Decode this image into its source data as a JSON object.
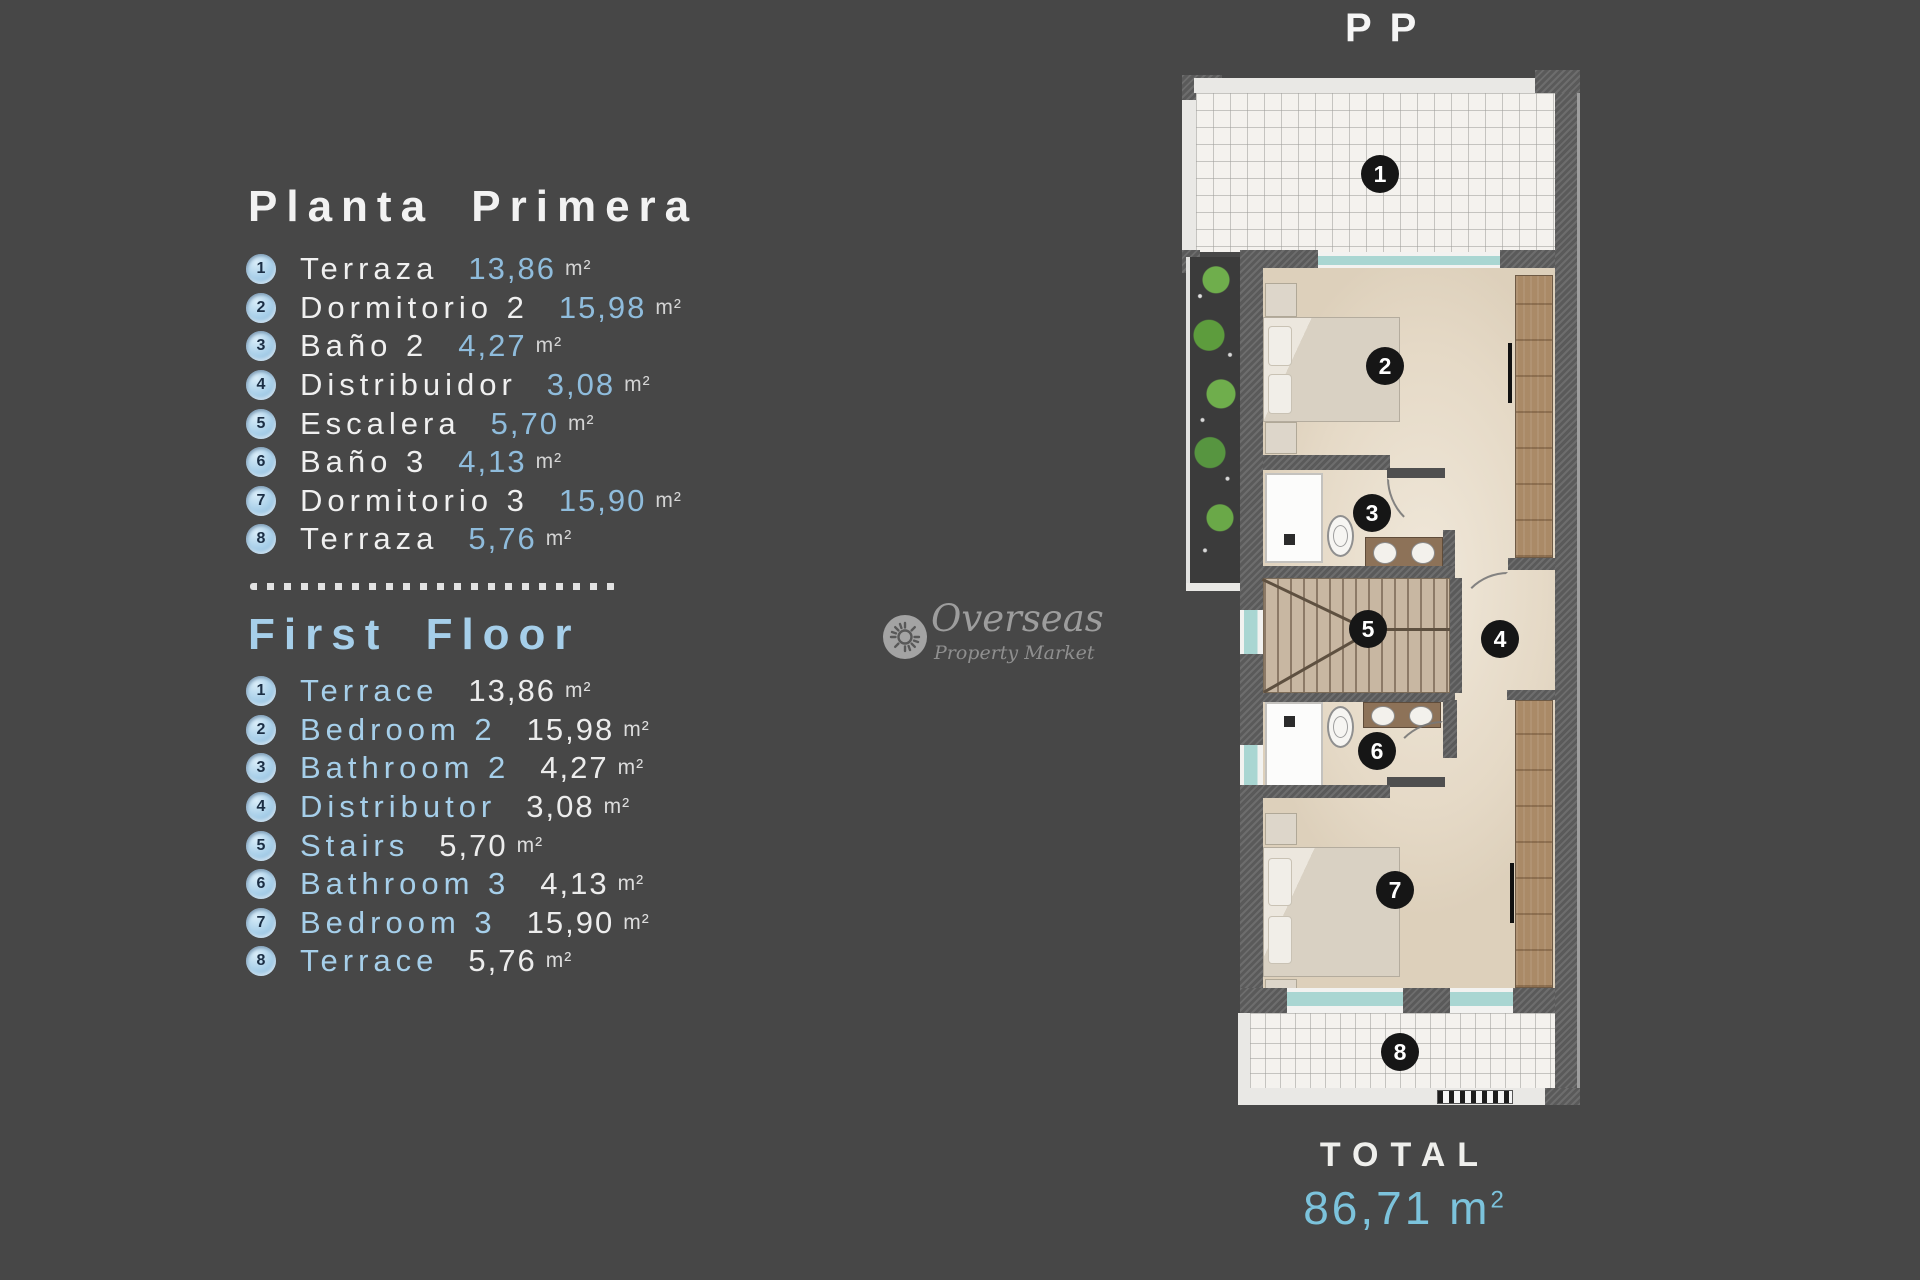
{
  "background": "#474747",
  "accent_blue": "#a6cfea",
  "value_blue": "#8fbcdc",
  "plan": {
    "title": "PP",
    "room_numbers": [
      "1",
      "2",
      "3",
      "4",
      "5",
      "6",
      "7",
      "8"
    ],
    "total": {
      "label": "TOTAL",
      "value": "86,71",
      "unit": "m",
      "sup": "2"
    }
  },
  "watermark": {
    "line1": "Overseas",
    "line2": "Property Market",
    "icon": "sun-icon"
  },
  "sections": [
    {
      "title": "Planta Primera",
      "items": [
        {
          "n": "1",
          "label": "Terraza",
          "value": "13,86",
          "unit": "m²"
        },
        {
          "n": "2",
          "label": "Dormitorio 2",
          "value": "15,98",
          "unit": "m²"
        },
        {
          "n": "3",
          "label": "Baño 2",
          "value": "4,27",
          "unit": "m²"
        },
        {
          "n": "4",
          "label": "Distribuidor",
          "value": "3,08",
          "unit": "m²"
        },
        {
          "n": "5",
          "label": "Escalera",
          "value": "5,70",
          "unit": "m²"
        },
        {
          "n": "6",
          "label": "Baño 3",
          "value": "4,13",
          "unit": "m²"
        },
        {
          "n": "7",
          "label": "Dormitorio 3",
          "value": "15,90",
          "unit": "m²"
        },
        {
          "n": "8",
          "label": "Terraza",
          "value": "5,76",
          "unit": "m²"
        }
      ]
    },
    {
      "title": "First Floor",
      "items": [
        {
          "n": "1",
          "label": "Terrace",
          "value": "13,86",
          "unit": "m²"
        },
        {
          "n": "2",
          "label": "Bedroom 2",
          "value": "15,98",
          "unit": "m²"
        },
        {
          "n": "3",
          "label": "Bathroom 2",
          "value": "4,27",
          "unit": "m²"
        },
        {
          "n": "4",
          "label": "Distributor",
          "value": "3,08",
          "unit": "m²"
        },
        {
          "n": "5",
          "label": "Stairs",
          "value": "5,70",
          "unit": "m²"
        },
        {
          "n": "6",
          "label": "Bathroom 3",
          "value": "4,13",
          "unit": "m²"
        },
        {
          "n": "7",
          "label": "Bedroom 3",
          "value": "15,90",
          "unit": "m²"
        },
        {
          "n": "8",
          "label": "Terrace",
          "value": "5,76",
          "unit": "m²"
        }
      ]
    }
  ]
}
